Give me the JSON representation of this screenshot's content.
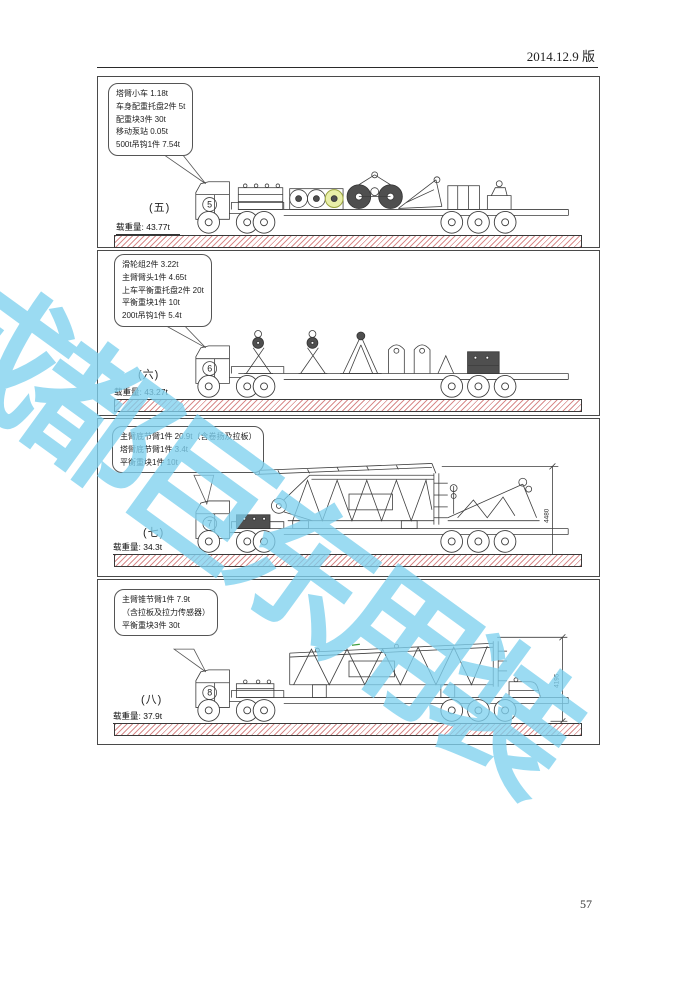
{
  "header": {
    "version_label": "2014.12.9 版"
  },
  "watermark": {
    "text": "成都巨东用装",
    "color": "#7fd1ef"
  },
  "footer": {
    "page_number": "57"
  },
  "colors": {
    "ground_hatch": "#d98c8c",
    "line_art": "#3d3d3d"
  },
  "panels": [
    {
      "label": "(五)",
      "number": "5",
      "load_label": "载重量: 43.77t",
      "callout": [
        "塔臂小车  1.18t",
        "车身配重托盘2件  5t",
        "配重块3件 30t",
        "移动泵站 0.05t",
        "500t吊钩1件 7.54t"
      ]
    },
    {
      "label": "(六)",
      "number": "6",
      "load_label": "载重量: 43.27t",
      "callout": [
        "滑轮组2件  3.22t",
        "主臂臂头1件  4.65t",
        "上车平衡重托盘2件 20t",
        "平衡重块1件 10t",
        "200t吊钩1件 5.4t"
      ]
    },
    {
      "label": "(七)",
      "number": "7",
      "load_label": "载重量: 34.3t",
      "dimension": "4480",
      "callout": [
        "主臂底节臂1件  20.9t（含卷扬及拉板）",
        "塔臂底节臂1件  3.4t",
        "平衡重块1件 10t"
      ]
    },
    {
      "label": "(八)",
      "number": "8",
      "load_label": "载重量: 37.9t",
      "dimension": "4195",
      "callout": [
        "主臂锥节臂1件  7.9t",
        "（含拉板及拉力传感器）",
        "平衡重块3件 30t"
      ]
    }
  ]
}
